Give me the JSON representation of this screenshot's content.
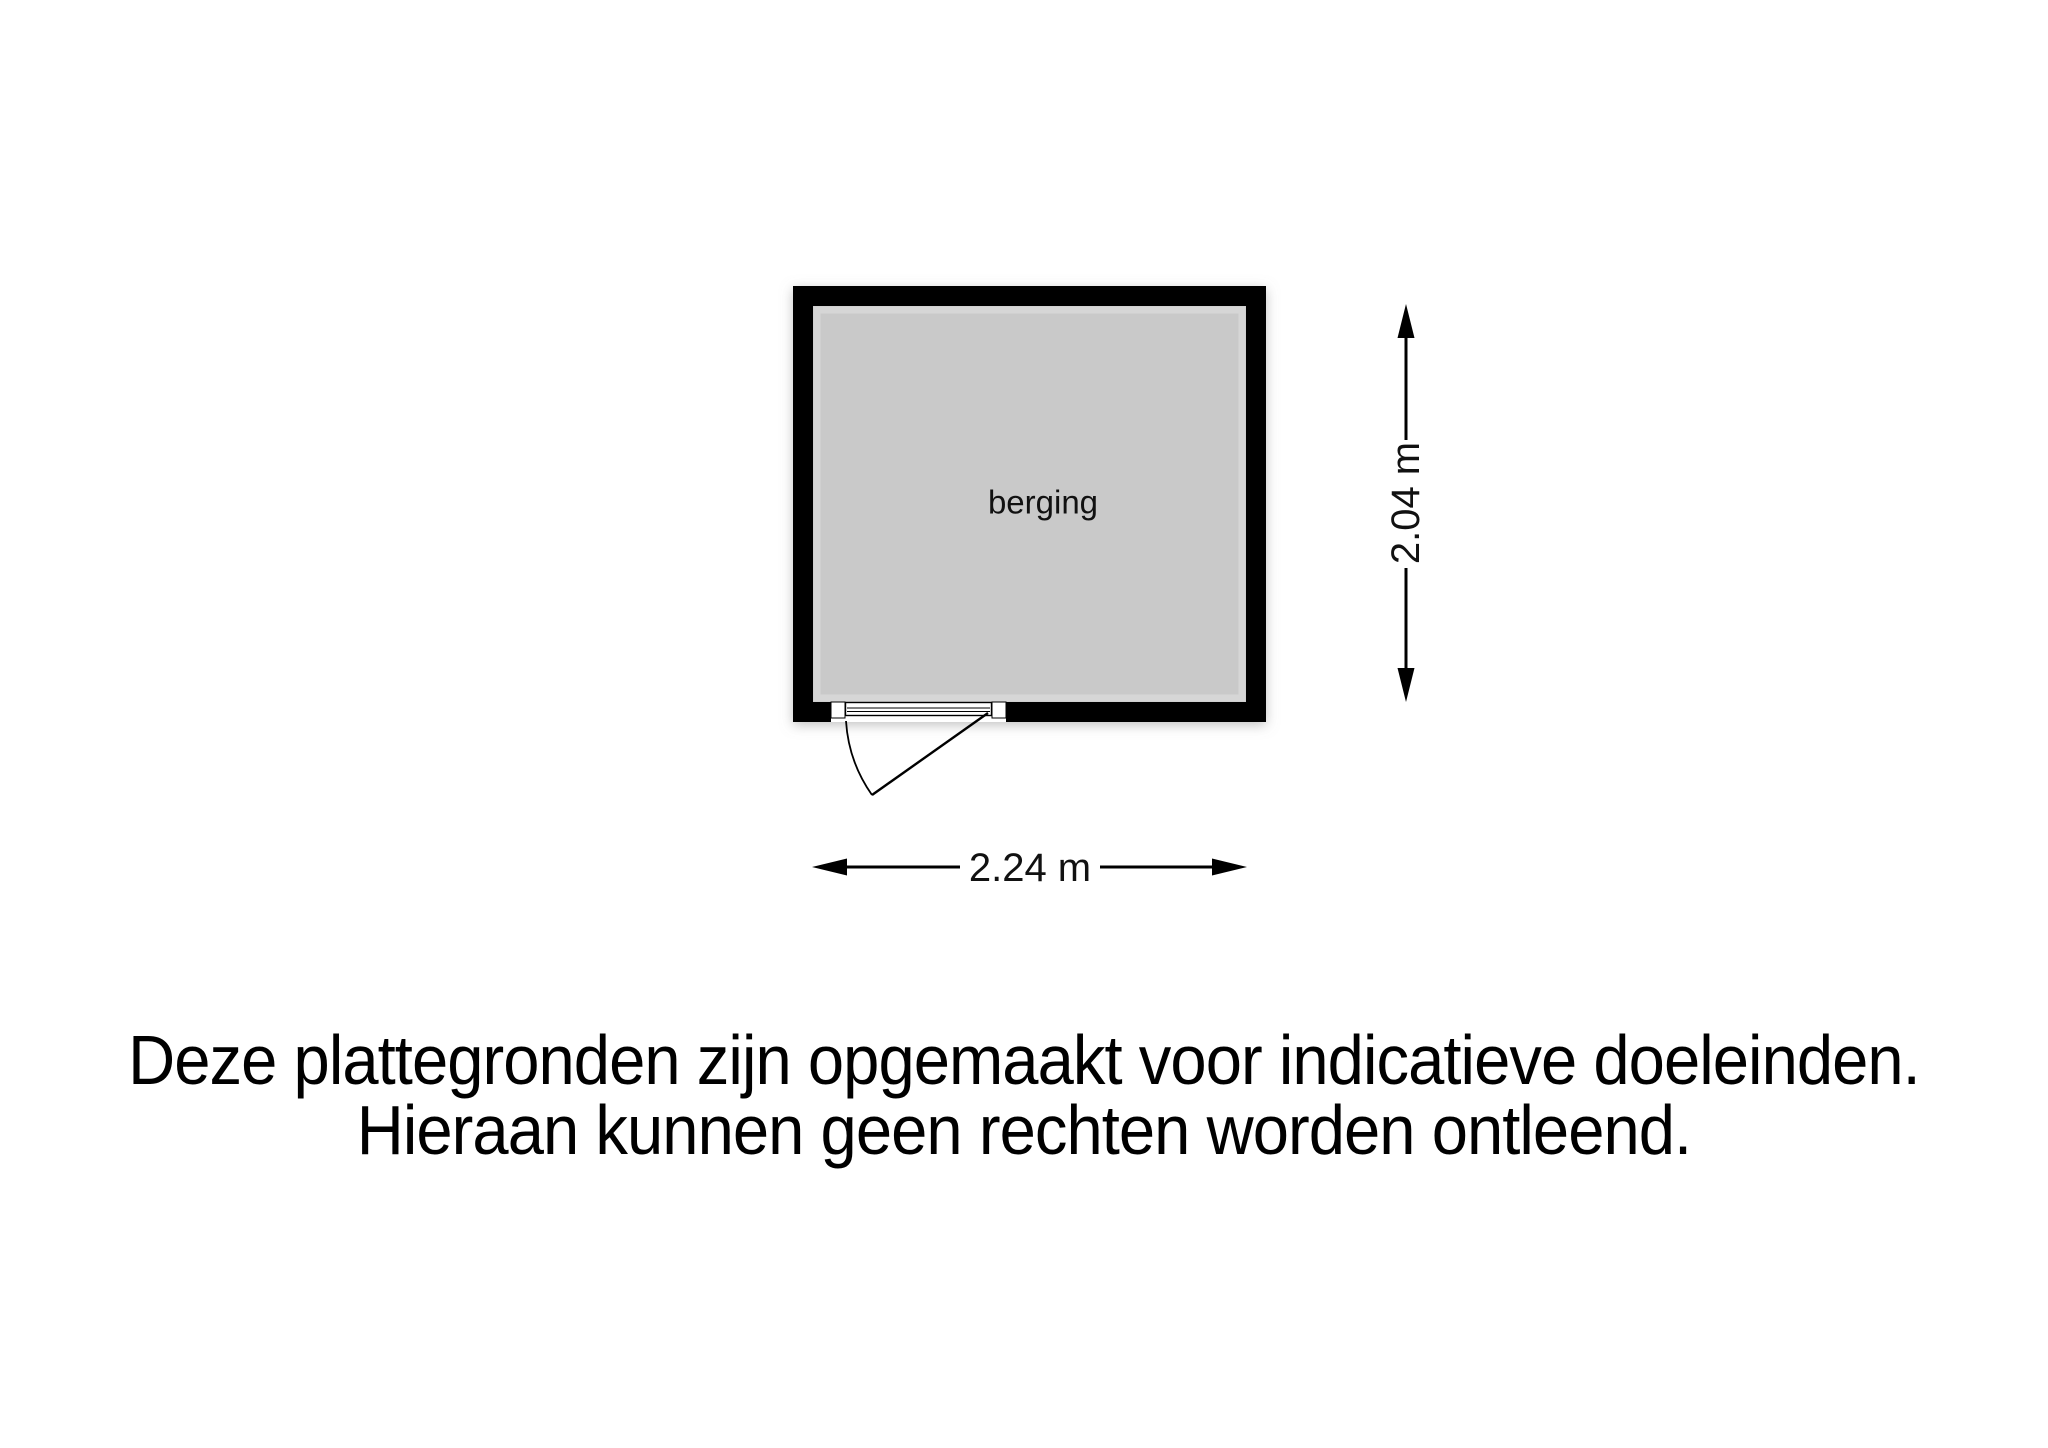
{
  "floor_plan": {
    "room_label": "berging",
    "width_dimension_label": "2.24 m",
    "height_dimension_label": "2.04 m",
    "colors": {
      "wall": "#000000",
      "floor": "#c9c9c9",
      "background": "#ffffff",
      "line": "#000000"
    }
  },
  "disclaimer": {
    "line1": "Deze plattegronden zijn opgemaakt voor indicatieve doeleinden.",
    "line2": "Hieraan kunnen geen rechten worden ontleend."
  }
}
